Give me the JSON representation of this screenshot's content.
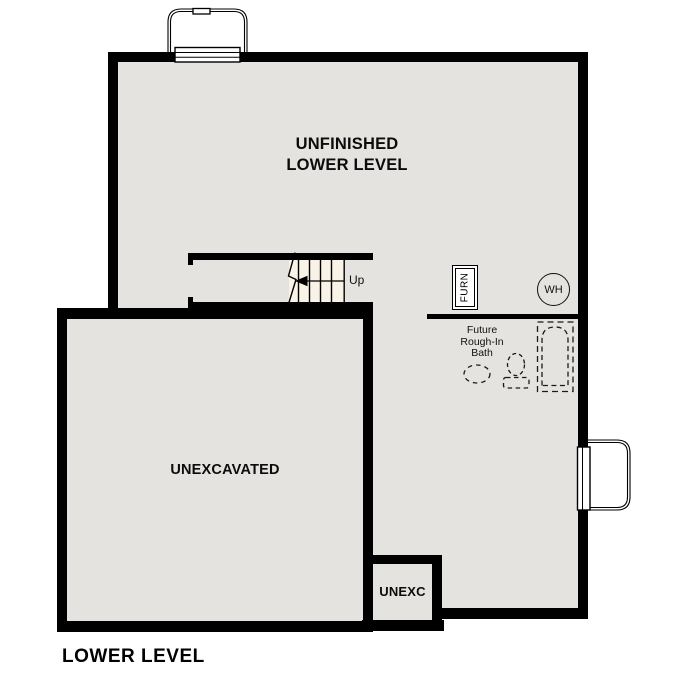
{
  "colors": {
    "wall": "#000000",
    "floor_fill": "#e5e3e0",
    "stairs_fill": "#f8f2e7",
    "background": "#ffffff",
    "dashed_fixture": "#1a1a1a"
  },
  "plan": {
    "title": "LOWER LEVEL",
    "rooms": {
      "unfinished": {
        "line1": "UNFINISHED",
        "line2": "LOWER LEVEL"
      },
      "unexcavated": {
        "label": "UNEXCAVATED"
      },
      "unexc": {
        "label": "UNEXC"
      },
      "future_bath": {
        "line1": "Future",
        "line2": "Rough-In",
        "line3": "Bath"
      }
    },
    "stairs": {
      "up_label": "Up"
    },
    "equipment": {
      "furnace_label": "FURN",
      "water_heater_label": "WH"
    }
  }
}
